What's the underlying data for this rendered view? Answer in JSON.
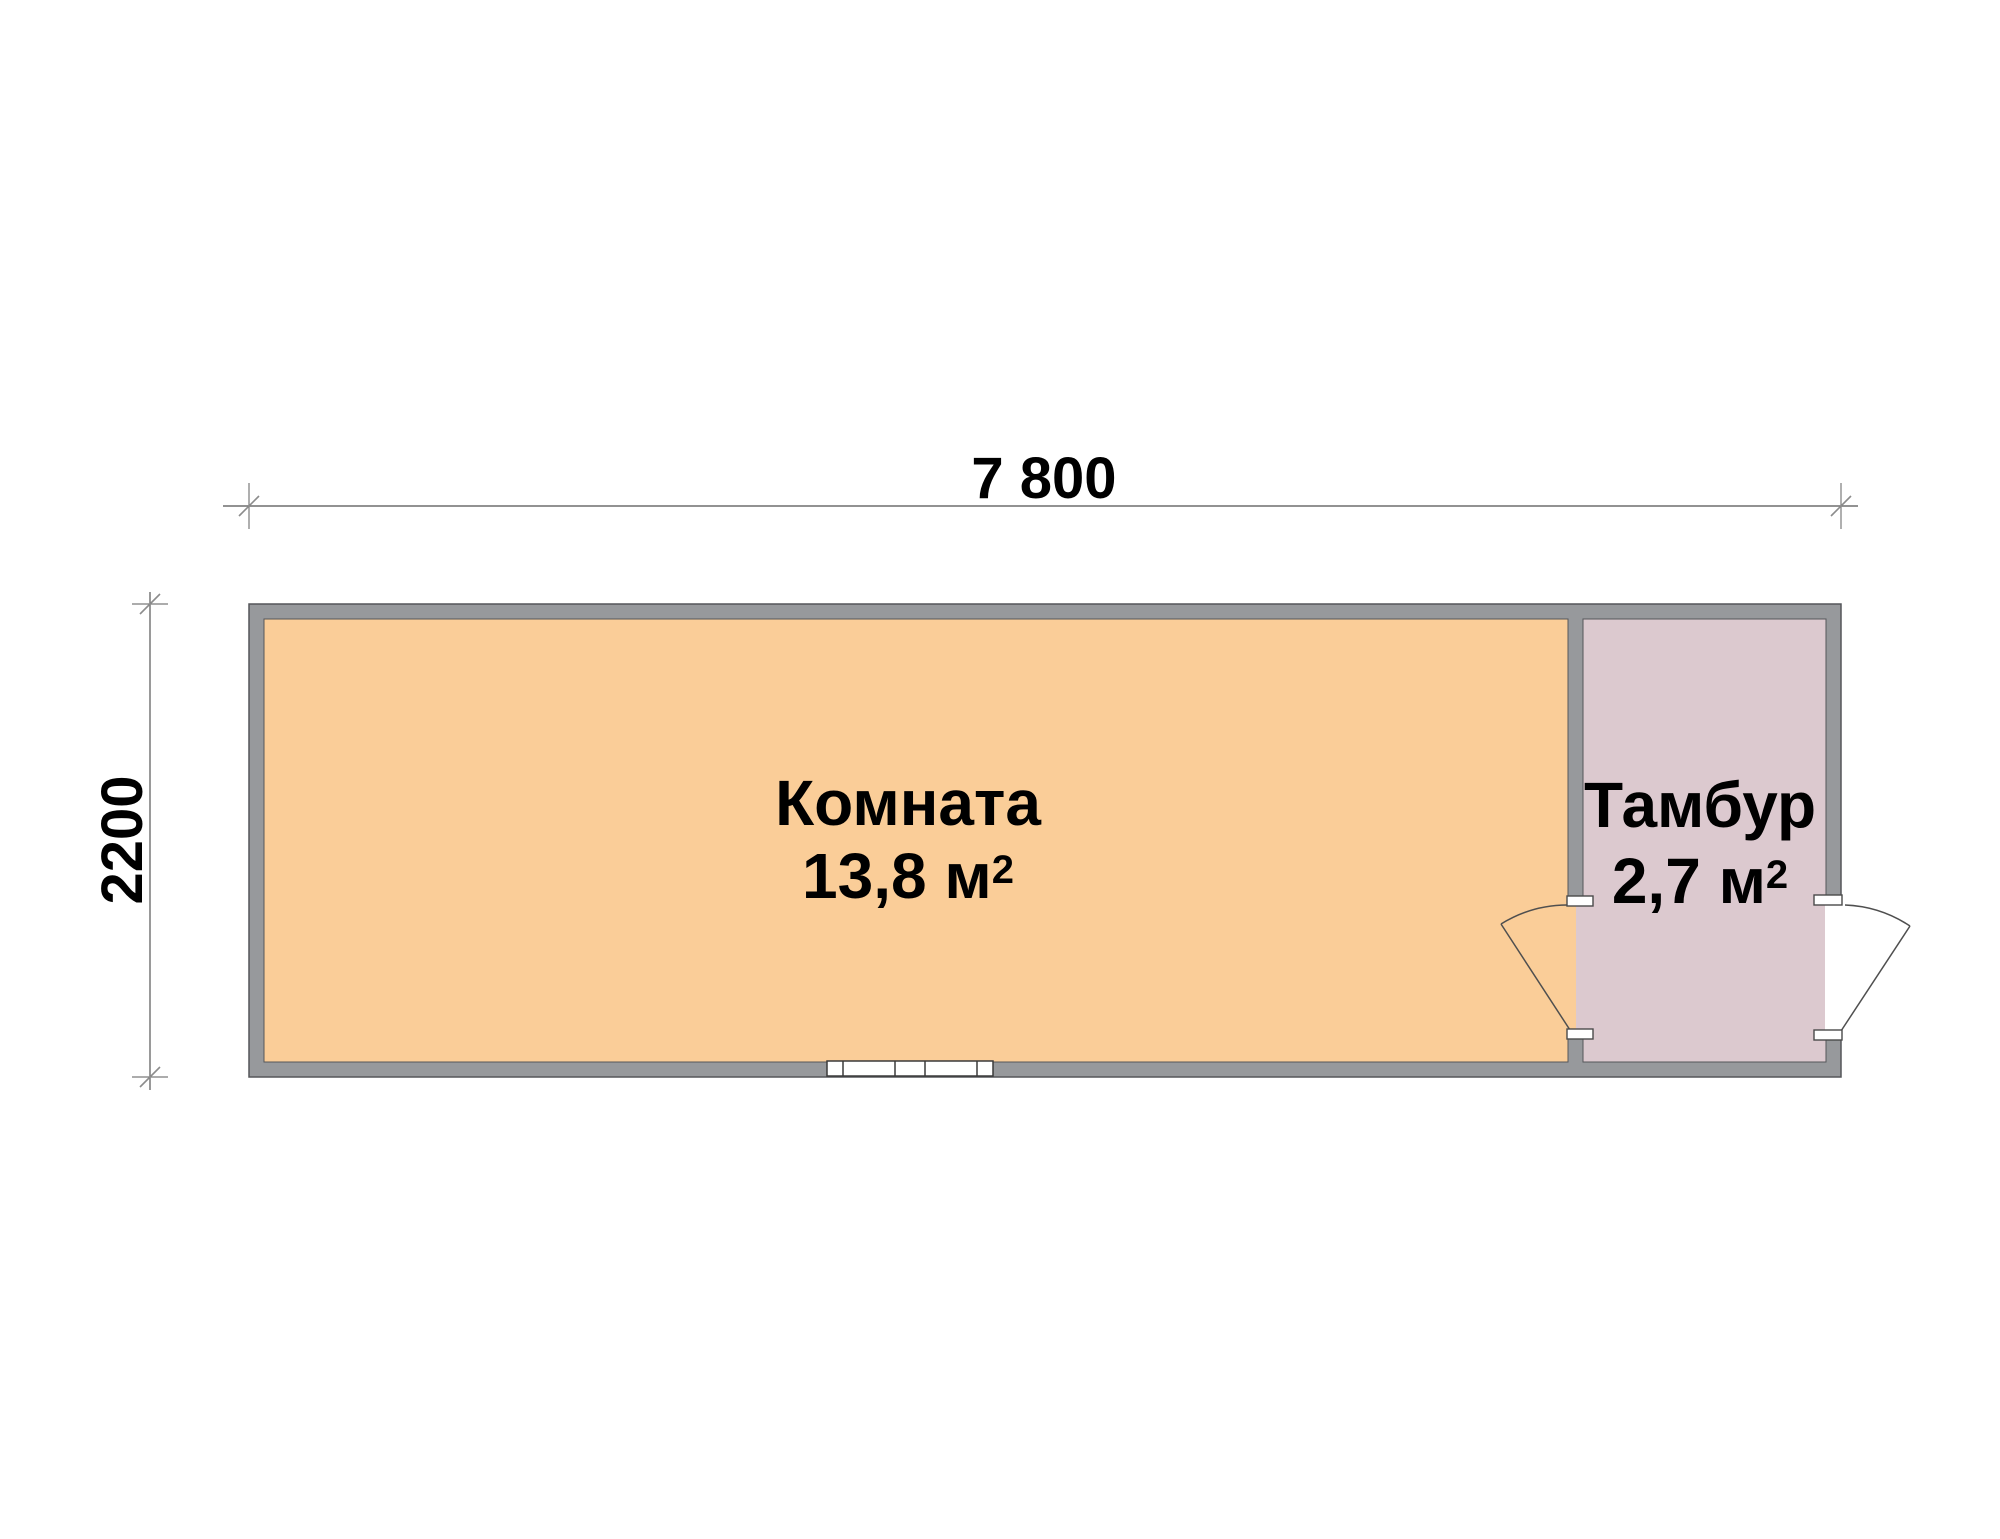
{
  "plan": {
    "title": "floor-plan",
    "overall": {
      "width_label": "7 800",
      "height_label": "2200"
    },
    "rooms": [
      {
        "name": "Комната",
        "area_label": "13,8 м",
        "area_superscript": "2",
        "fill_color": "#FACD98"
      },
      {
        "name": "Тамбур",
        "area_label": "2,7 м",
        "area_superscript": "2",
        "fill_color": "#DCC9CF"
      }
    ],
    "colors": {
      "wall_fill": "#97999C",
      "wall_outline": "#55565A",
      "dimension_line": "#6E6E6E",
      "text": "#000000",
      "window_fill": "#FFFFFF"
    }
  }
}
